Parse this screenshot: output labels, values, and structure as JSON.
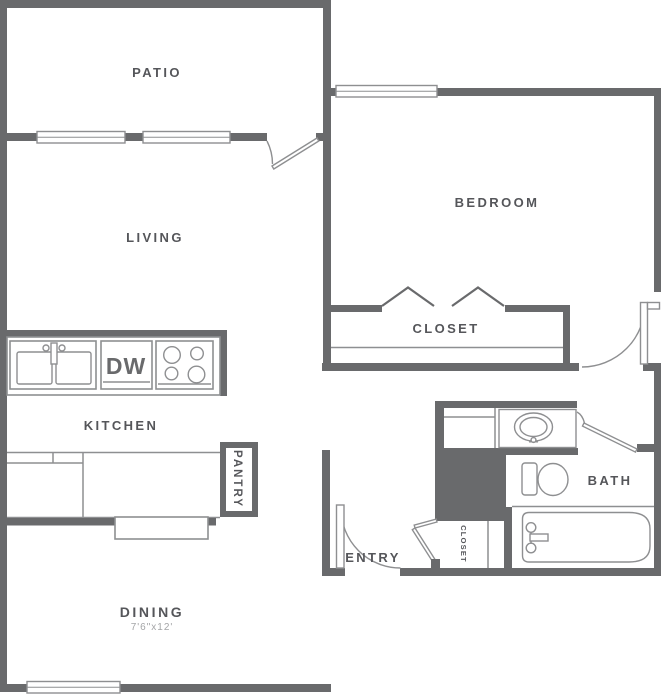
{
  "title": "one-bedroom apartment floor plan",
  "colors": {
    "wall": "#696a6c",
    "line": "#8e8f91",
    "label": "#55565a",
    "dim": "#a4a5a7",
    "bg": "#ffffff"
  },
  "rooms": {
    "patio": {
      "label": "PATIO"
    },
    "living": {
      "label": "LIVING"
    },
    "bedroom": {
      "label": "BEDROOM"
    },
    "bedroom_closet": {
      "label": "CLOSET"
    },
    "kitchen": {
      "label": "KITCHEN"
    },
    "pantry": {
      "label": "PANTRY"
    },
    "dining": {
      "label": "DINING",
      "dimensions": "7'6\"x12'"
    },
    "entry": {
      "label": "ENTRY"
    },
    "entry_closet": {
      "label": "CLOSET"
    },
    "bath": {
      "label": "BATH"
    }
  },
  "appliances": {
    "dishwasher": {
      "label": "DW"
    }
  }
}
